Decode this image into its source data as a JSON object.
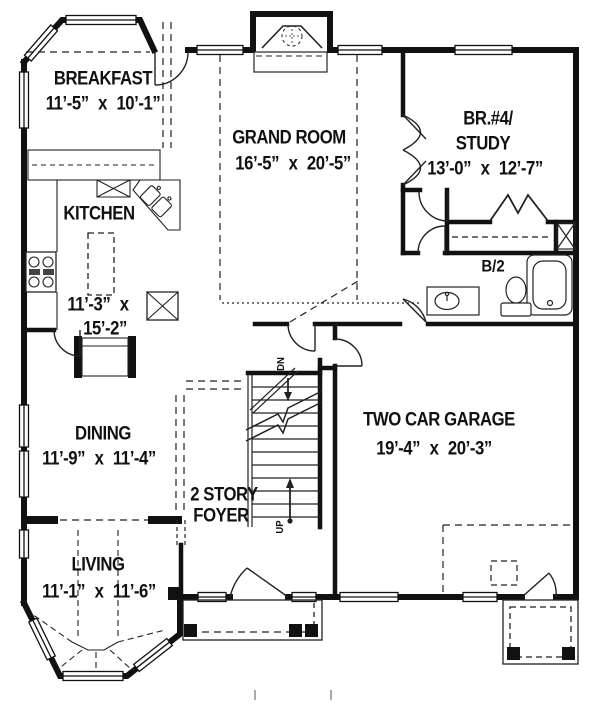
{
  "drawing": {
    "type": "architectural-first-floor-plan",
    "colors": {
      "ink": "#111111",
      "paper": "#ffffff"
    }
  },
  "rooms": {
    "breakfast": {
      "name": "BREAKFAST",
      "dims": "11’-5” x 10’-1”"
    },
    "grand_room": {
      "name": "GRAND ROOM",
      "dims": "16’-5” x 20’-5”"
    },
    "br4_study": {
      "name_line1": "BR.#4/",
      "name_line2": "STUDY",
      "dims": "13’-0” x 12’-7”"
    },
    "kitchen": {
      "name": "KITCHEN",
      "dims_line1": "11’-3” x",
      "dims_line2": "15’-2”"
    },
    "half_bath": {
      "name": "B/2"
    },
    "dining": {
      "name": "DINING",
      "dims": "11’-9” x 11’-4”"
    },
    "foyer": {
      "name_line1": "2 STORY",
      "name_line2": "FOYER"
    },
    "garage": {
      "name": "TWO CAR GARAGE",
      "dims": "19’-4” x 20’-3”"
    },
    "living": {
      "name": "LIVING",
      "dims": "11’-1” x 11’-6”"
    }
  },
  "stairs": {
    "down_label": "DN",
    "up_label": "UP"
  }
}
